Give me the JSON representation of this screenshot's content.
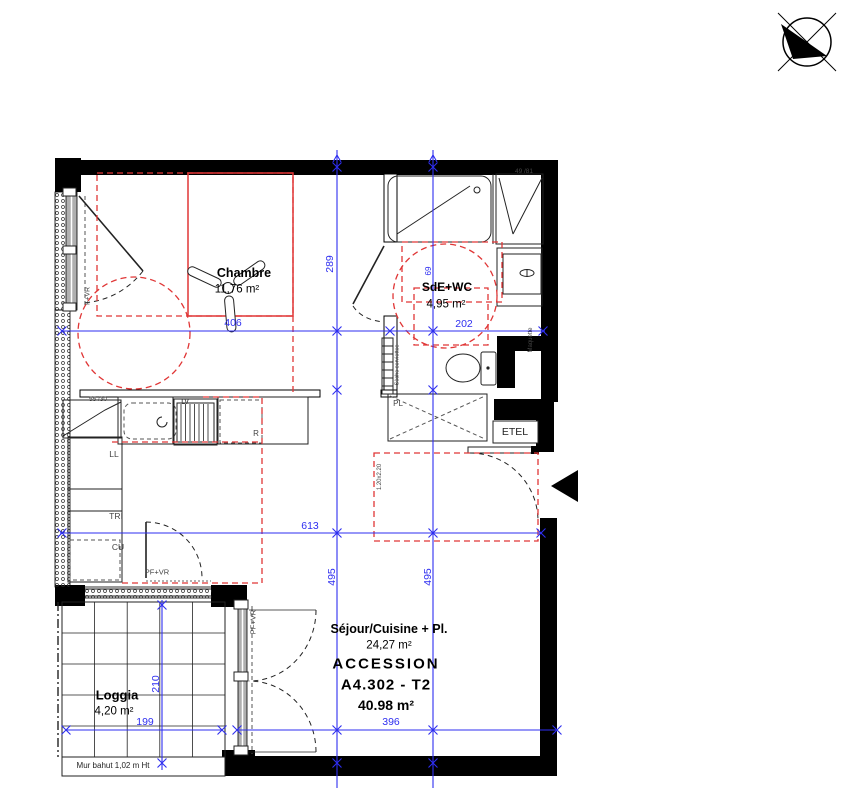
{
  "plan": {
    "rooms": {
      "chambre": {
        "name": "Chambre",
        "area": "11,76 m²"
      },
      "sde": {
        "name": "SdE+WC",
        "area": "4,95 m²"
      },
      "sejour": {
        "name": "Séjour/Cuisine + Pl.",
        "area": "24,27 m²"
      },
      "loggia": {
        "name": "Loggia",
        "area": "4,20 m²"
      }
    },
    "unit": {
      "program": "ACCESSION",
      "lot": "A4.302 - T2",
      "total_area": "40.98 m²"
    },
    "dimensions": {
      "chambre_width": "406",
      "sde_width": "202",
      "chambre_height": "289",
      "niche": "69",
      "sejour_width": "613",
      "sejour_height_left": "495",
      "sejour_height_right": "495",
      "loggia_height": "210",
      "loggia_width": "199",
      "sejour_bottom": "396"
    },
    "annotations": {
      "window_left": "F+VR",
      "window_kitchen": "55 /30",
      "window_sde": "49 /81",
      "door_sejour": "PF+VR",
      "door_loggia": "PF+VR",
      "washer": "LL",
      "sorting": "TRI",
      "cu": "CU",
      "dishwasher": "LV",
      "fridge": "R",
      "closet": "PL",
      "electrical": "ETEL",
      "towel_dryer": "Sèche serviettes",
      "maquette": "Maquette",
      "clearance": "1.20x2.20",
      "wall_note": "Mur bahut 1,02 m Ht"
    },
    "icons": {
      "north_arrow": "north-arrow-compass",
      "entry_arrow": "entry-direction-triangle"
    },
    "colors": {
      "dimension_blue": "#2e2ef0",
      "furniture_red": "#e03636",
      "wall_black": "#000000",
      "annotation_gray": "#444444"
    }
  }
}
